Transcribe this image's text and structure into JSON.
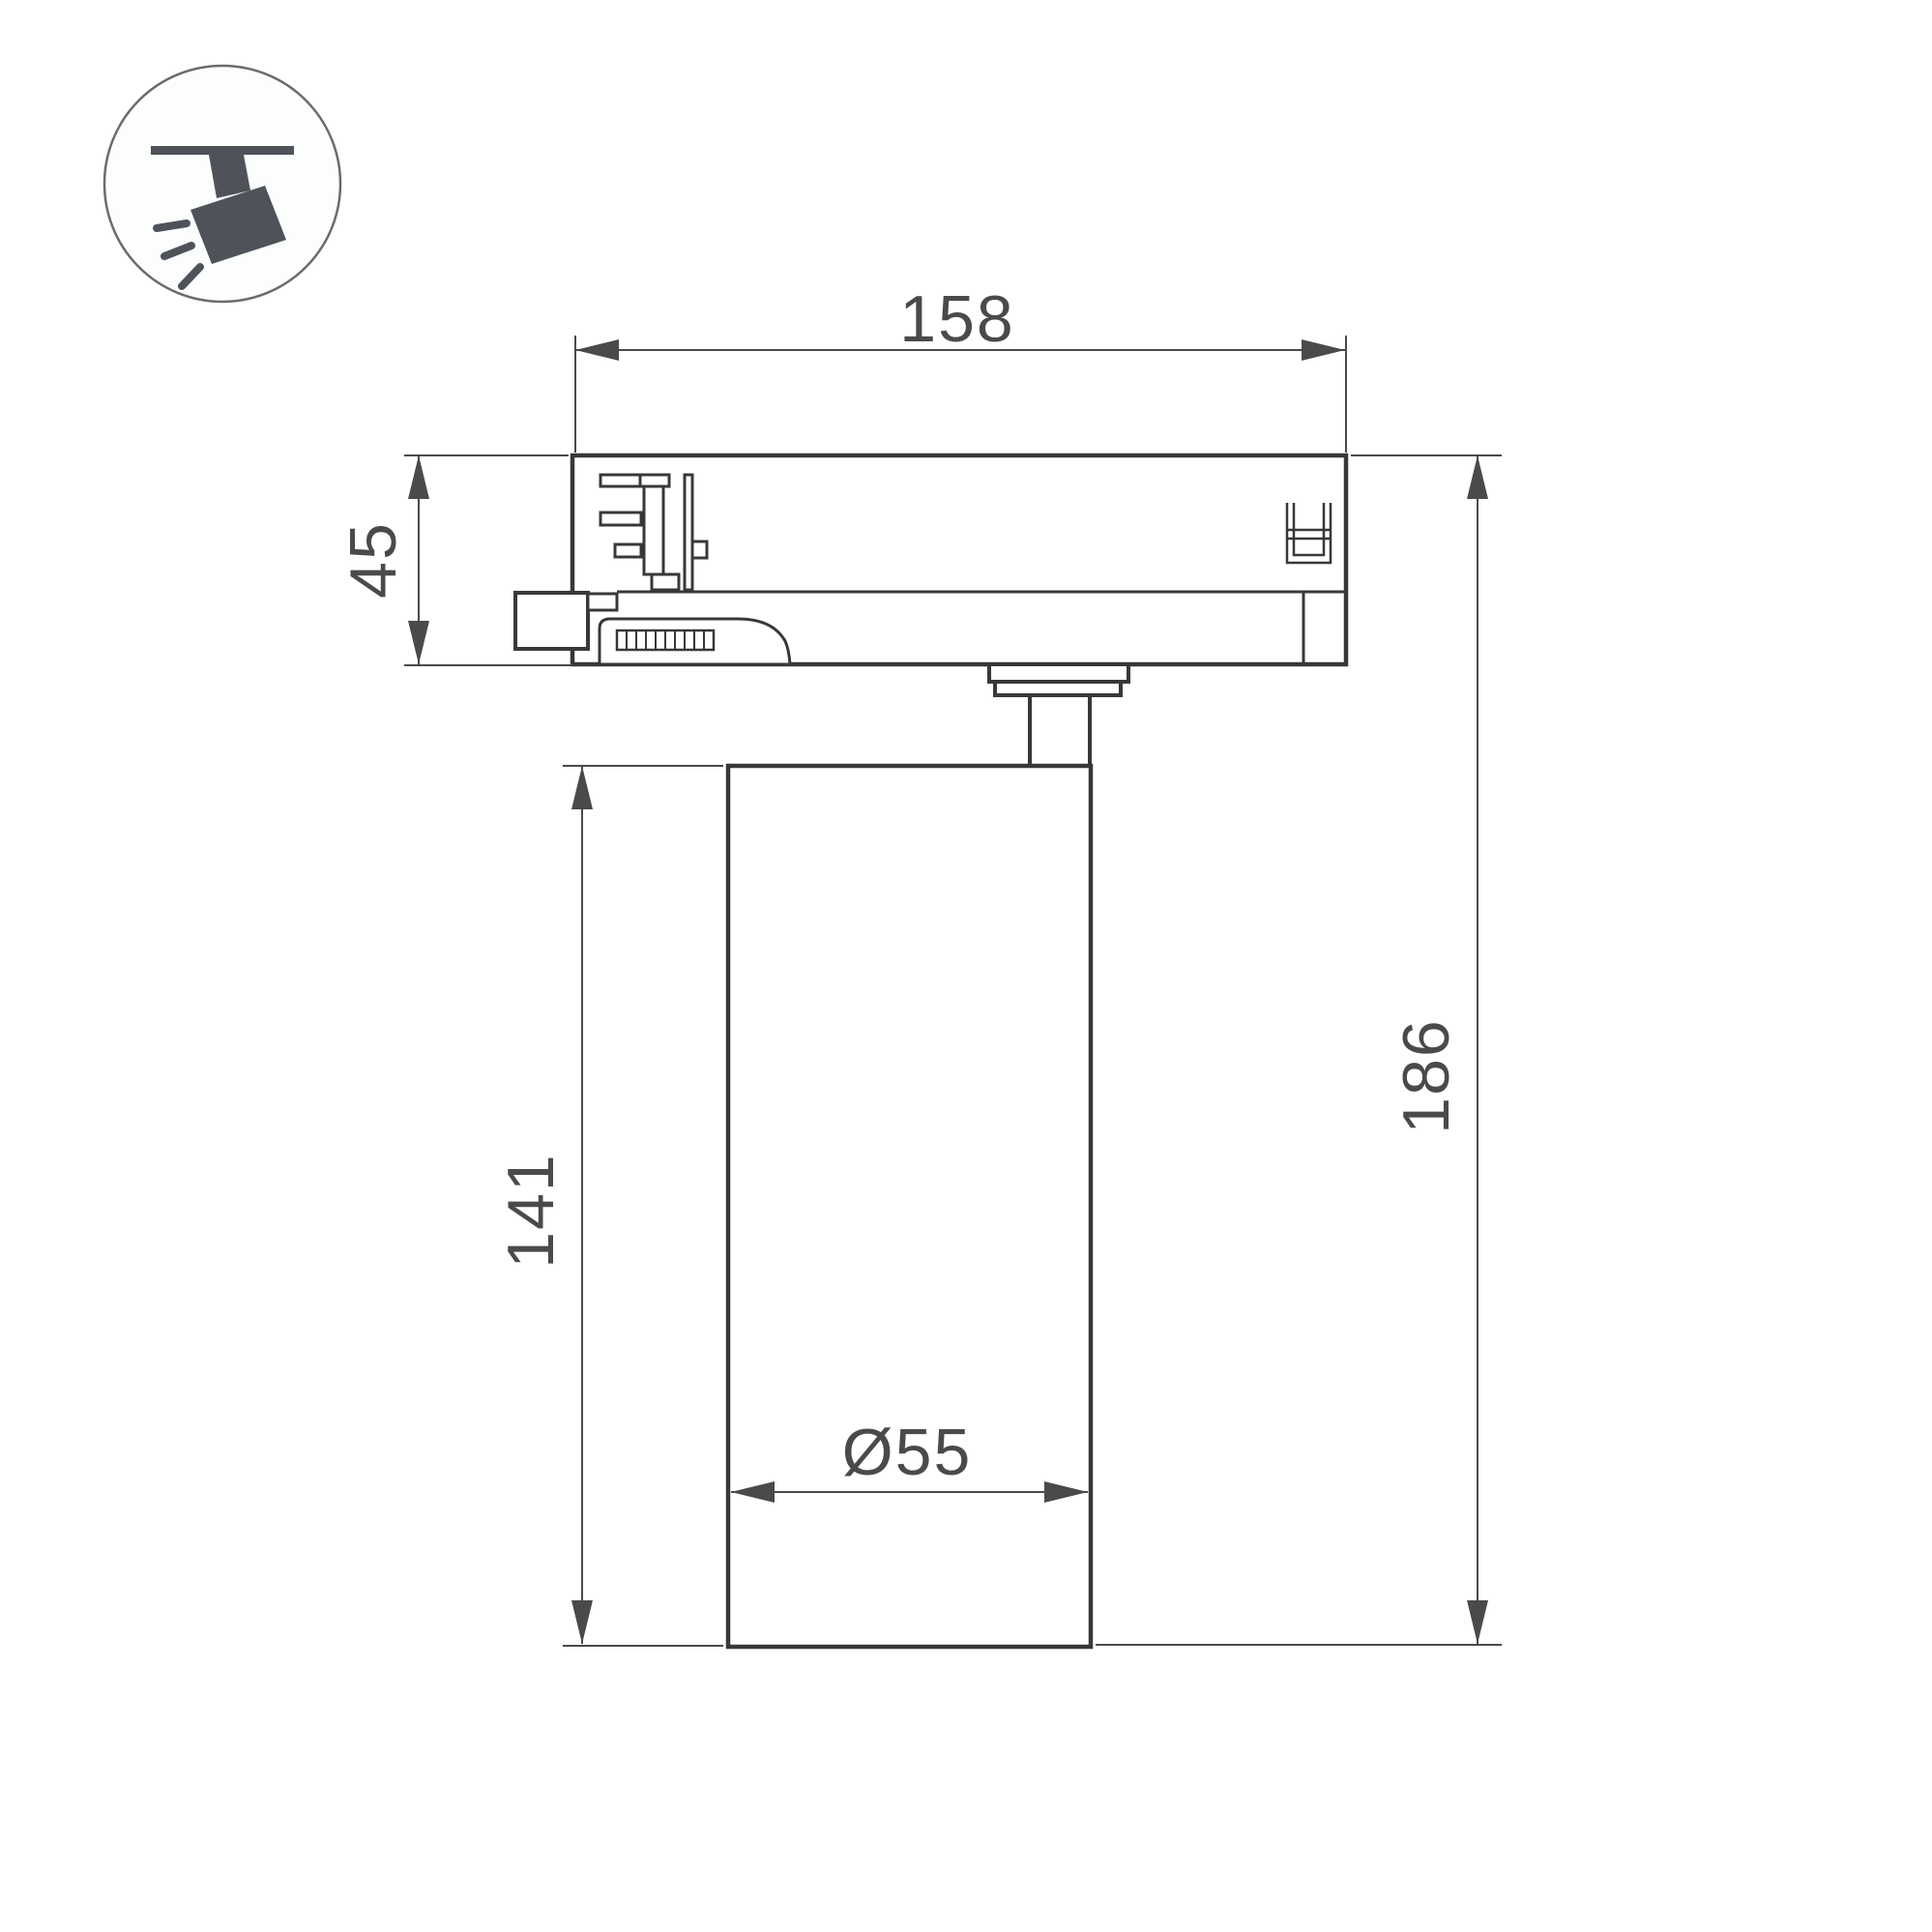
{
  "drawing": {
    "title": "track-spotlight-technical-drawing"
  },
  "colors": {
    "outline": "#383838",
    "dim": "#4a4a4a",
    "icon": "#4d5359",
    "iconborder": "#6b6b6b"
  },
  "icon": {
    "name": "track-spotlight"
  },
  "dimensions": {
    "track_width": {
      "value": "158"
    },
    "adapter_height": {
      "value": "45"
    },
    "body_height": {
      "value": "141"
    },
    "total_height": {
      "value": "186"
    },
    "body_diameter": {
      "value": "Ø55"
    }
  }
}
